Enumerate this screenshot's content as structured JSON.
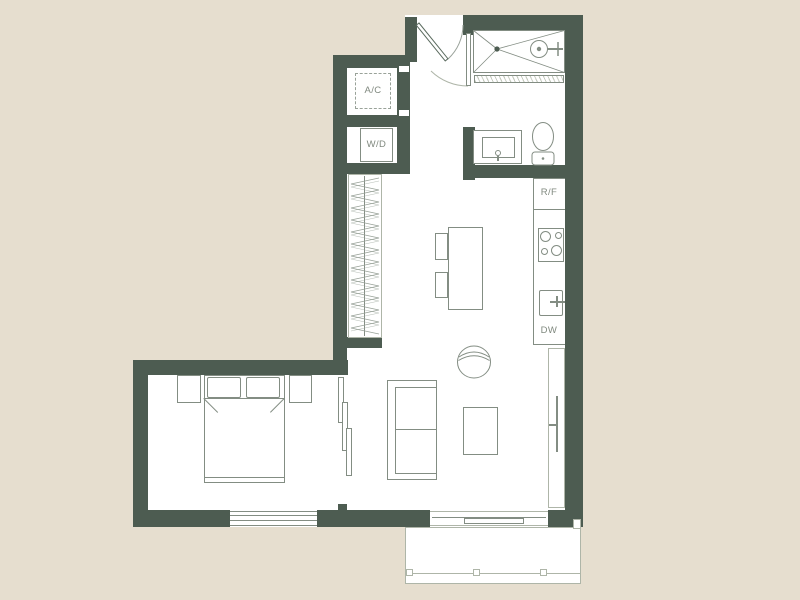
{
  "plan": {
    "labels": {
      "ac": "A/C",
      "wd": "W/D",
      "rf": "R/F",
      "dw": "DW"
    },
    "colors": {
      "background": "#e6decf",
      "wall": "#4d5c51",
      "line": "#838d83",
      "linelight": "#aeb5a8",
      "text": "#80897f",
      "floor": "#ffffff"
    }
  }
}
